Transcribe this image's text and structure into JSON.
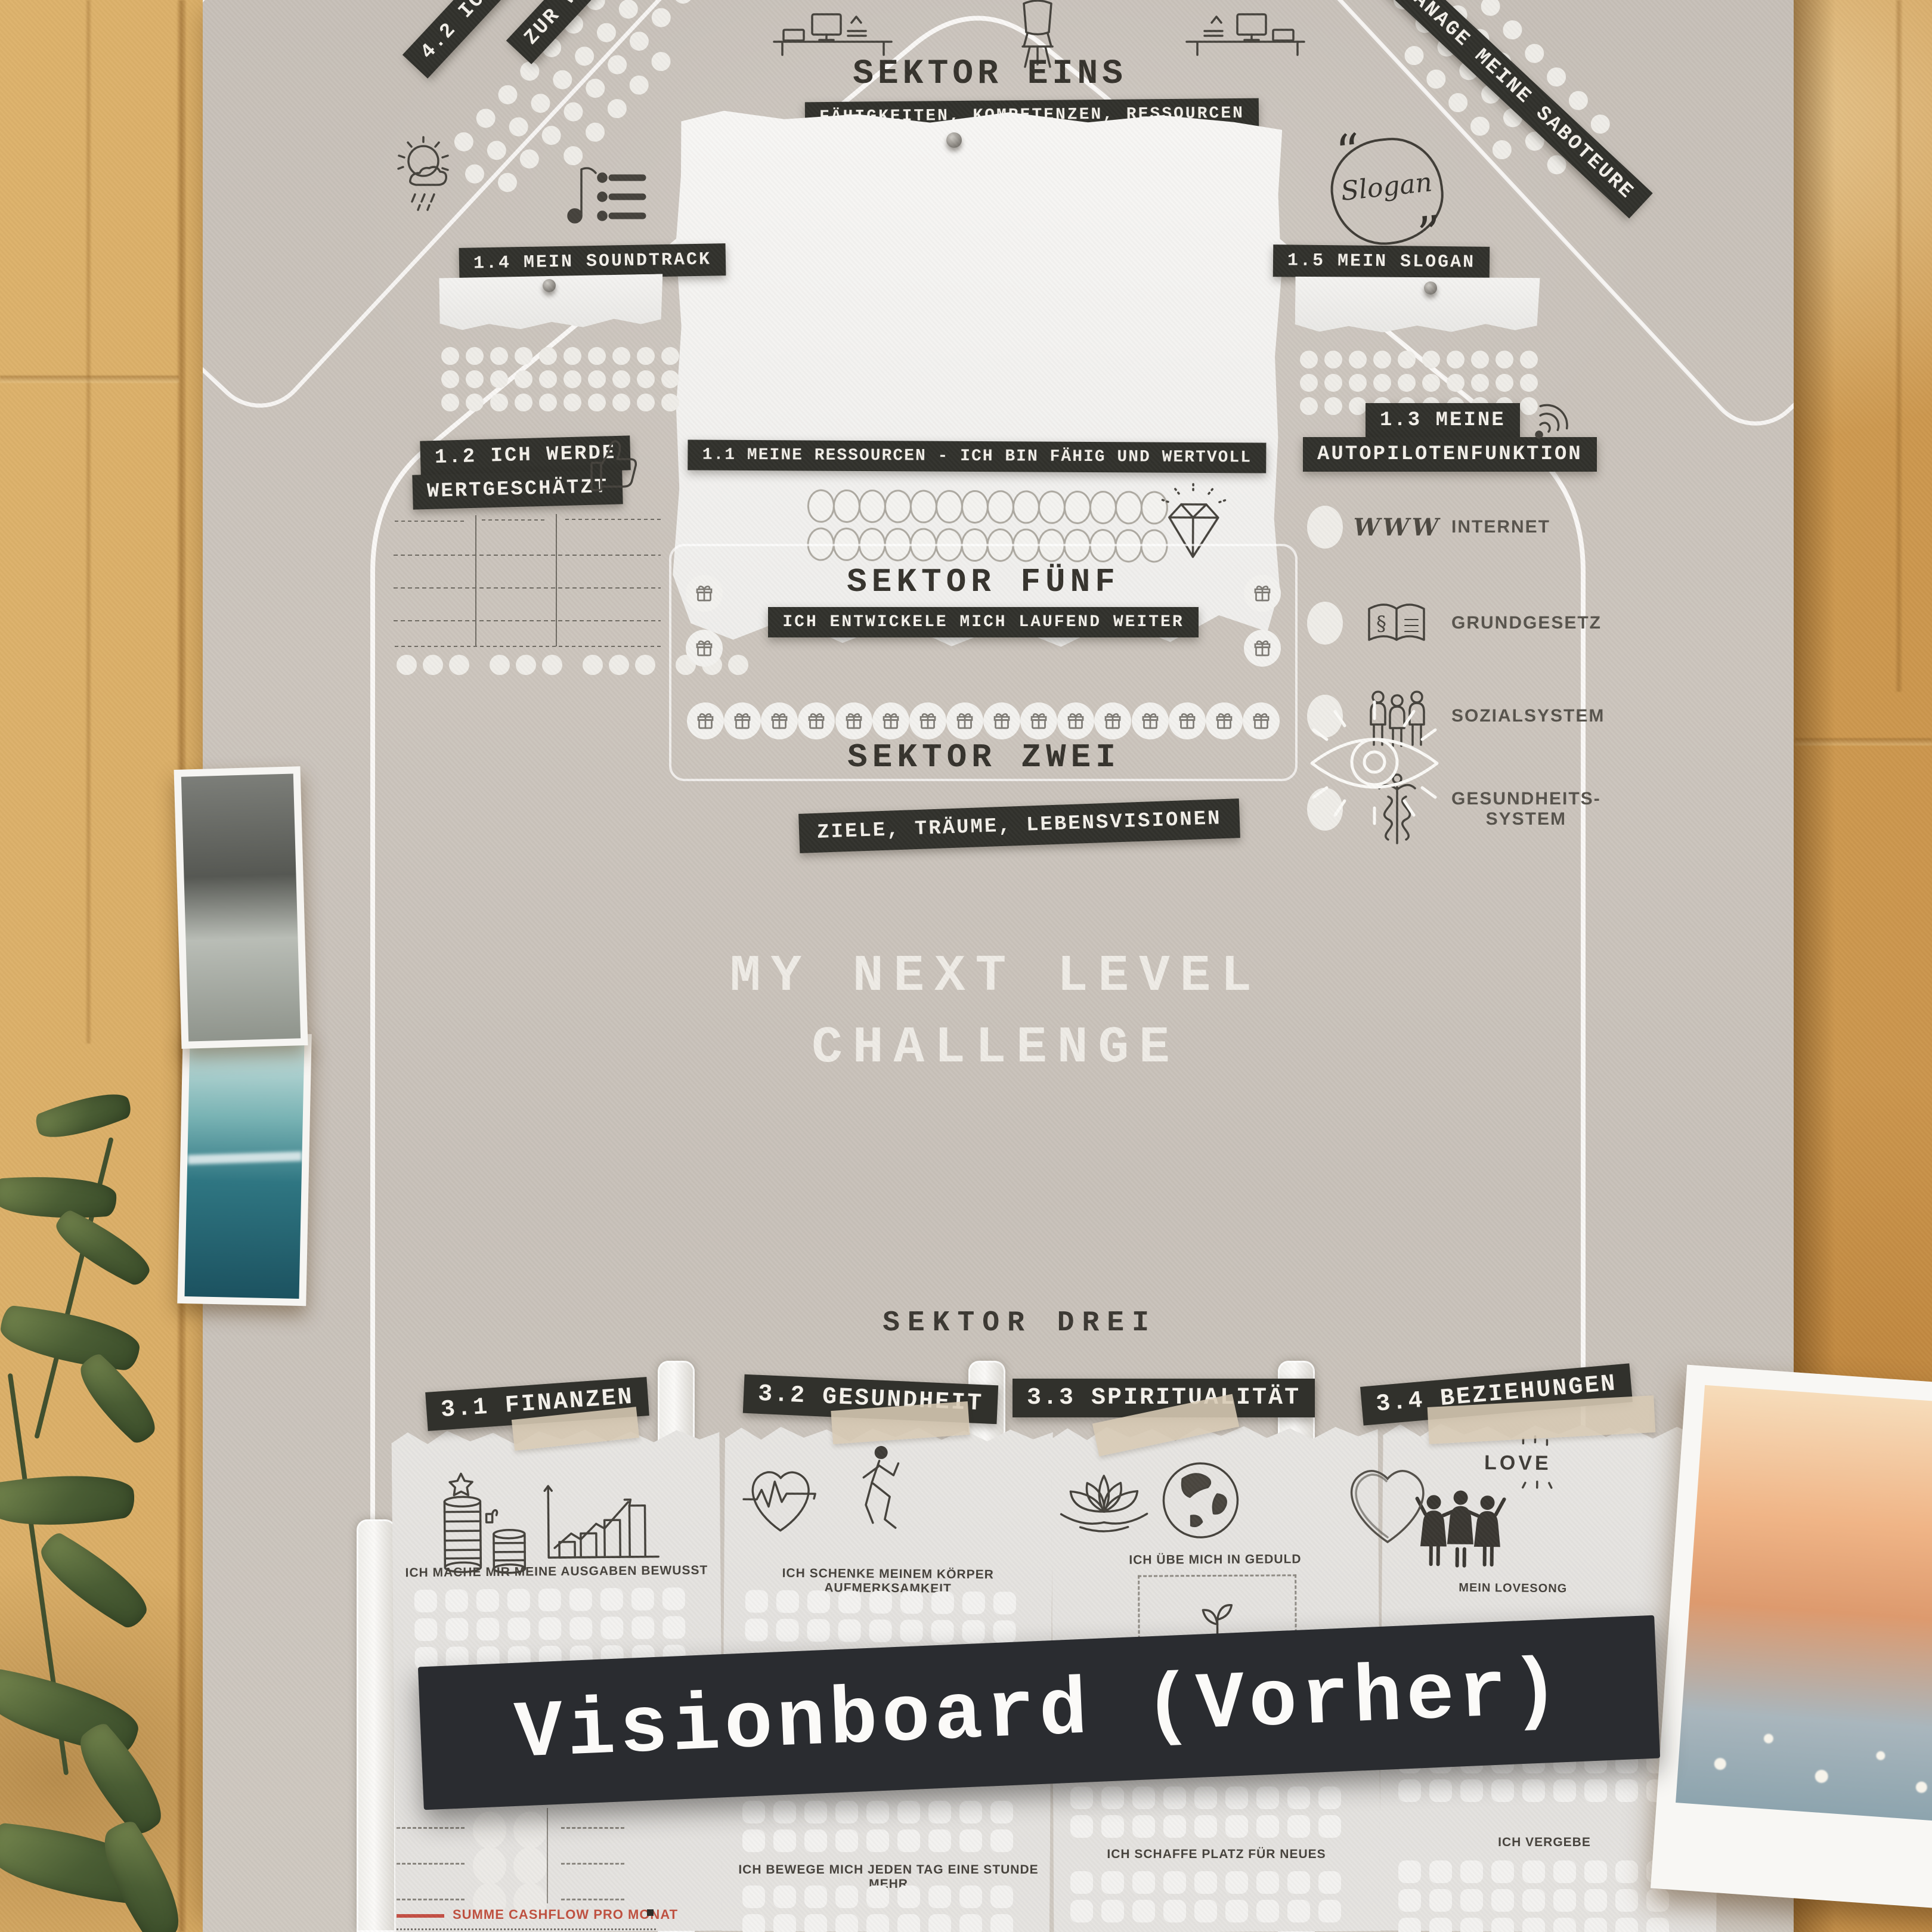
{
  "meta": {
    "banner": "Visionboard (Vorher)"
  },
  "poster": {
    "sector_one": {
      "title": "SEKTOR EINS",
      "subtitle": "FÄHIGKEITEN, KOMPETENZEN, RESSOURCEN"
    },
    "corner_labels": {
      "left_line1": "4.2 ICH NUTZE",
      "left_line2": "ZUR WE",
      "right": "MANAGE MEINE SABOTEURE"
    },
    "items": {
      "i11": {
        "label": "1.1 MEINE RESSOURCEN - ICH BIN FÄHIG UND WERTVOLL"
      },
      "i12": {
        "line1": "1.2 ICH WERDE",
        "line2": "WERTGESCHÄTZT"
      },
      "i13": {
        "line1": "1.3 MEINE",
        "line2": "AUTOPILOTENFUNKTION",
        "rows": [
          {
            "icon": "www-icon",
            "www": "WWW",
            "text": "INTERNET"
          },
          {
            "icon": "law-book-icon",
            "text": "GRUNDGESETZ"
          },
          {
            "icon": "people-icon",
            "text": "SOZIALSYSTEM"
          },
          {
            "icon": "caduceus-icon",
            "text": "GESUNDHEITS-",
            "text2": "SYSTEM"
          }
        ]
      },
      "i14": {
        "label": "1.4 MEIN SOUNDTRACK"
      },
      "i15": {
        "label": "1.5 MEIN SLOGAN",
        "badge": "Slogan"
      }
    },
    "sector_five": {
      "title": "SEKTOR FÜNF",
      "subtitle": "ICH ENTWICKELE MICH LAUFEND WEITER"
    },
    "sector_two": {
      "title": "SEKTOR ZWEI",
      "subtitle": "ZIELE, TRÄUME, LEBENSVISIONEN"
    },
    "center_title": {
      "line1": "MY NEXT LEVEL",
      "line2": "CHALLENGE"
    },
    "sector_three": {
      "title": "SEKTOR DREI",
      "cards": [
        {
          "label": "3.1 FINANZEN",
          "caption": "ICH MACHE MIR MEINE AUSGABEN BEWUSST",
          "footer_caption": "SUMME CASHFLOW PRO MONAT"
        },
        {
          "label": "3.2 GESUNDHEIT",
          "caption": "ICH SCHENKE MEINEM KÖRPER AUFMERKSAMKEIT",
          "footer_caption": "ICH BEWEGE MICH JEDEN TAG EINE STUNDE MEHR"
        },
        {
          "label": "3.3 SPIRITUALITÄT",
          "caption": "ICH ÜBE MICH IN GEDULD",
          "footer_caption": "ICH SCHAFFE PLATZ FÜR NEUES"
        },
        {
          "label": "3.4 BEZIEHUNGEN",
          "caption": "MEIN LOVESONG",
          "footer_caption": "ICH VERGEBE",
          "love_text": "LOVE"
        }
      ]
    }
  },
  "colors": {
    "wall": "#d7a85f",
    "poster": "#c9c2ba",
    "chip_dark": "#31312c",
    "banner_dark": "#2a2c30",
    "card_paper": "#e4e2df",
    "accent_red": "#c44f44",
    "text_dark": "#36332d",
    "text_light": "#f3f0ea"
  },
  "icons": [
    "desk-computer-icon",
    "chair-icon",
    "sun-cloud-rain-icon",
    "music-playlist-icon",
    "quote-slogan-icon",
    "thumbs-up-icon",
    "diamond-icon",
    "gift-icon",
    "wifi-icon",
    "www-icon",
    "law-book-icon",
    "people-icon",
    "caduceus-icon",
    "eye-icon",
    "coins-star-icon",
    "bar-chart-icon",
    "heart-ekg-icon",
    "runner-icon",
    "lotus-icon",
    "globe-icon",
    "heart-icon",
    "friends-icon",
    "sprout-icon",
    "pin-icon"
  ]
}
